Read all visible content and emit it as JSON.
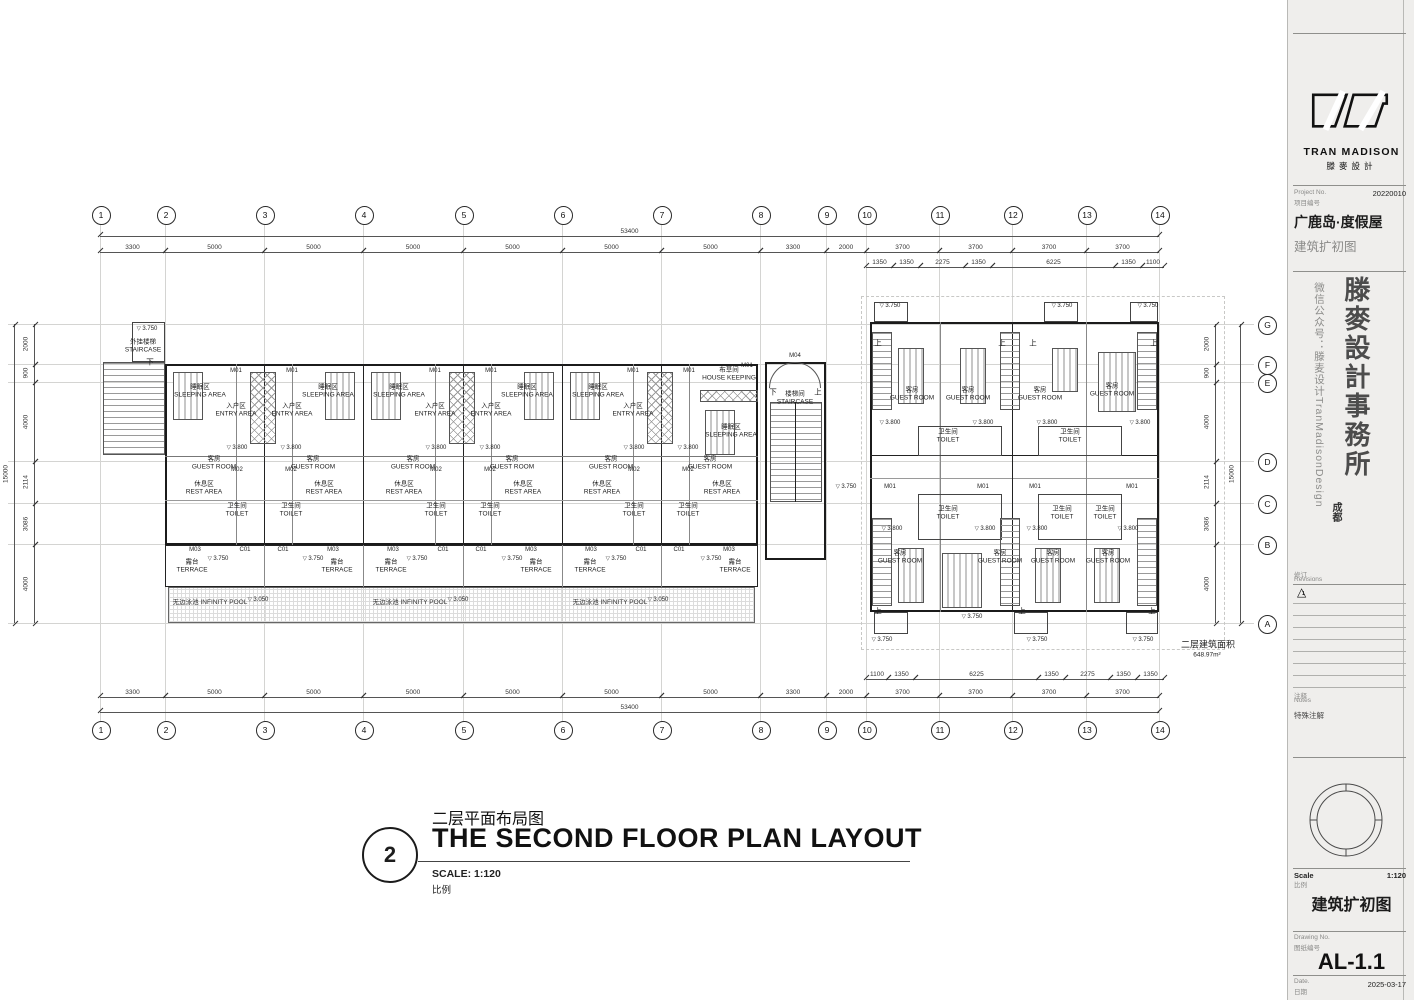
{
  "sheet": {
    "brand": "TRAN MADISON",
    "brand_zh": "滕麥設計",
    "project_no_label_en": "Project No.",
    "project_no_label_zh": "项目编号",
    "project_no": "20220010",
    "project_name_zh": "广鹿岛·度假屋",
    "project_stage_zh": "建筑扩初图",
    "wechat_vertical": "微信公众号：滕麦设计TranMadisonDesign",
    "office_vertical": "滕麥設計事務所",
    "office_city": "成都",
    "revisions_label_zh": "修订",
    "revisions_label_en": "Revisions",
    "revision_icon": "△",
    "revision_no": "1",
    "notes_label_zh": "注释",
    "notes_label_en": "Notes",
    "notes_special_zh": "特殊注解",
    "scale_label_en": "Scale",
    "scale_label_zh": "比例",
    "scale_value": "1:120",
    "stage_title_zh": "建筑扩初图",
    "drawing_no_label_en": "Drawing No.",
    "drawing_no_label_zh": "图纸编号",
    "drawing_no": "AL-1.1",
    "date_label_en": "Date.",
    "date_label_zh": "日期",
    "date_value": "2025-03-17"
  },
  "drawing_title": {
    "number": "2",
    "title_zh": "二层平面布局图",
    "title_en": "THE SECOND FLOOR PLAN LAYOUT",
    "scale_text": "SCALE: 1:120",
    "scale_zh": "比例"
  },
  "grid": {
    "columns": [
      {
        "label": "1",
        "x": 100
      },
      {
        "label": "2",
        "x": 165
      },
      {
        "label": "3",
        "x": 264
      },
      {
        "label": "4",
        "x": 363
      },
      {
        "label": "5",
        "x": 463
      },
      {
        "label": "6",
        "x": 562
      },
      {
        "label": "7",
        "x": 661
      },
      {
        "label": "8",
        "x": 760
      },
      {
        "label": "9",
        "x": 826
      },
      {
        "label": "10",
        "x": 866
      },
      {
        "label": "11",
        "x": 939
      },
      {
        "label": "12",
        "x": 1012
      },
      {
        "label": "13",
        "x": 1086
      },
      {
        "label": "14",
        "x": 1159
      }
    ],
    "col_boundaries": [
      100,
      165,
      264,
      363,
      463,
      562,
      661,
      760,
      826,
      866,
      939,
      1012,
      1086,
      1159
    ],
    "col_dim_values": [
      "3300",
      "5000",
      "5000",
      "5000",
      "5000",
      "5000",
      "5000",
      "3300",
      "2000",
      "3700",
      "3700",
      "3700",
      "3700"
    ],
    "col_total": "53400",
    "sub_top": {
      "boundaries": [
        866,
        893,
        920,
        965,
        992,
        1115,
        1142,
        1164
      ],
      "values": [
        "1350",
        "1350",
        "2275",
        "1350",
        "6225",
        "1350",
        "1100"
      ]
    },
    "sub_bottom": {
      "boundaries": [
        866,
        888,
        915,
        1038,
        1065,
        1110,
        1137,
        1164
      ],
      "values": [
        "1100",
        "1350",
        "6225",
        "1350",
        "2275",
        "1350",
        "1350"
      ]
    },
    "rows": [
      {
        "label": "G",
        "y": 324
      },
      {
        "label": "F",
        "y": 364
      },
      {
        "label": "E",
        "y": 382
      },
      {
        "label": "D",
        "y": 461
      },
      {
        "label": "C",
        "y": 503
      },
      {
        "label": "B",
        "y": 544
      },
      {
        "label": "A",
        "y": 623
      }
    ],
    "row_boundaries": [
      324,
      364,
      382,
      461,
      503,
      544,
      623
    ],
    "row_dim_values": [
      "2000",
      "900",
      "4000",
      "2114",
      "3086",
      "4000"
    ],
    "row_total": "15000"
  },
  "plan_labels": [
    [
      147,
      329,
      "3.750",
      "level"
    ],
    [
      143,
      347,
      "外挂楼梯\nSTAIRCASE",
      "room"
    ],
    [
      150,
      362,
      "下",
      "dir"
    ],
    [
      236,
      371,
      "M01",
      "tag"
    ],
    [
      292,
      371,
      "M01",
      "tag"
    ],
    [
      435,
      371,
      "M01",
      "tag"
    ],
    [
      491,
      371,
      "M01",
      "tag"
    ],
    [
      633,
      371,
      "M01",
      "tag"
    ],
    [
      689,
      371,
      "M01",
      "tag"
    ],
    [
      747,
      366,
      "M01",
      "tag"
    ],
    [
      795,
      356,
      "M04",
      "tag"
    ],
    [
      236,
      411,
      "入户区\nENTRY AREA",
      "room"
    ],
    [
      292,
      411,
      "入户区\nENTRY AREA",
      "room"
    ],
    [
      435,
      411,
      "入户区\nENTRY AREA",
      "room"
    ],
    [
      491,
      411,
      "入户区\nENTRY AREA",
      "room"
    ],
    [
      633,
      411,
      "入户区\nENTRY AREA",
      "room"
    ],
    [
      200,
      392,
      "睡眠区\nSLEEPING AREA",
      "room"
    ],
    [
      328,
      392,
      "睡眠区\nSLEEPING AREA",
      "room"
    ],
    [
      399,
      392,
      "睡眠区\nSLEEPING AREA",
      "room"
    ],
    [
      527,
      392,
      "睡眠区\nSLEEPING AREA",
      "room"
    ],
    [
      598,
      392,
      "睡眠区\nSLEEPING AREA",
      "room"
    ],
    [
      731,
      432,
      "睡眠区\nSLEEPING AREA",
      "room"
    ],
    [
      237,
      448,
      "3.800",
      "level"
    ],
    [
      291,
      448,
      "3.800",
      "level"
    ],
    [
      436,
      448,
      "3.800",
      "level"
    ],
    [
      490,
      448,
      "3.800",
      "level"
    ],
    [
      634,
      448,
      "3.800",
      "level"
    ],
    [
      688,
      448,
      "3.800",
      "level"
    ],
    [
      214,
      464,
      "客房\nGUEST ROOM",
      "room"
    ],
    [
      313,
      464,
      "客房\nGUEST ROOM",
      "room"
    ],
    [
      413,
      464,
      "客房\nGUEST ROOM",
      "room"
    ],
    [
      512,
      464,
      "客房\nGUEST ROOM",
      "room"
    ],
    [
      611,
      464,
      "客房\nGUEST ROOM",
      "room"
    ],
    [
      710,
      464,
      "客房\nGUEST ROOM",
      "room"
    ],
    [
      237,
      470,
      "M02",
      "tag"
    ],
    [
      291,
      470,
      "M02",
      "tag"
    ],
    [
      436,
      470,
      "M02",
      "tag"
    ],
    [
      490,
      470,
      "M02",
      "tag"
    ],
    [
      634,
      470,
      "M02",
      "tag"
    ],
    [
      688,
      470,
      "M02",
      "tag"
    ],
    [
      204,
      489,
      "休息区\nREST AREA",
      "room"
    ],
    [
      324,
      489,
      "休息区\nREST AREA",
      "room"
    ],
    [
      404,
      489,
      "休息区\nREST AREA",
      "room"
    ],
    [
      523,
      489,
      "休息区\nREST AREA",
      "room"
    ],
    [
      602,
      489,
      "休息区\nREST AREA",
      "room"
    ],
    [
      722,
      489,
      "休息区\nREST AREA",
      "room"
    ],
    [
      237,
      511,
      "卫生间\nTOILET",
      "room"
    ],
    [
      291,
      511,
      "卫生间\nTOILET",
      "room"
    ],
    [
      436,
      511,
      "卫生间\nTOILET",
      "room"
    ],
    [
      490,
      511,
      "卫生间\nTOILET",
      "room"
    ],
    [
      634,
      511,
      "卫生间\nTOILET",
      "room"
    ],
    [
      688,
      511,
      "卫生间\nTOILET",
      "room"
    ],
    [
      195,
      550,
      "M03",
      "tag"
    ],
    [
      333,
      550,
      "M03",
      "tag"
    ],
    [
      393,
      550,
      "M03",
      "tag"
    ],
    [
      531,
      550,
      "M03",
      "tag"
    ],
    [
      591,
      550,
      "M03",
      "tag"
    ],
    [
      729,
      550,
      "M03",
      "tag"
    ],
    [
      245,
      550,
      "C01",
      "tag"
    ],
    [
      283,
      550,
      "C01",
      "tag"
    ],
    [
      443,
      550,
      "C01",
      "tag"
    ],
    [
      481,
      550,
      "C01",
      "tag"
    ],
    [
      641,
      550,
      "C01",
      "tag"
    ],
    [
      679,
      550,
      "C01",
      "tag"
    ],
    [
      192,
      567,
      "露台\nTERRACE",
      "room"
    ],
    [
      337,
      567,
      "露台\nTERRACE",
      "room"
    ],
    [
      391,
      567,
      "露台\nTERRACE",
      "room"
    ],
    [
      536,
      567,
      "露台\nTERRACE",
      "room"
    ],
    [
      590,
      567,
      "露台\nTERRACE",
      "room"
    ],
    [
      735,
      567,
      "露台\nTERRACE",
      "room"
    ],
    [
      218,
      559,
      "3.750",
      "level"
    ],
    [
      313,
      559,
      "3.750",
      "level"
    ],
    [
      417,
      559,
      "3.750",
      "level"
    ],
    [
      512,
      559,
      "3.750",
      "level"
    ],
    [
      616,
      559,
      "3.750",
      "level"
    ],
    [
      711,
      559,
      "3.750",
      "level"
    ],
    [
      210,
      601,
      "无边泳池 INFINITY POOL",
      "pool-l"
    ],
    [
      410,
      601,
      "无边泳池 INFINITY POOL",
      "pool-l"
    ],
    [
      610,
      601,
      "无边泳池 INFINITY POOL",
      "pool-l"
    ],
    [
      258,
      600,
      "3.050",
      "level"
    ],
    [
      458,
      600,
      "3.050",
      "level"
    ],
    [
      658,
      600,
      "3.050",
      "level"
    ],
    [
      795,
      399,
      "楼梯间\nSTAIRCASE",
      "room"
    ],
    [
      773,
      392,
      "下",
      "dir"
    ],
    [
      818,
      392,
      "上",
      "dir"
    ],
    [
      846,
      487,
      "3.750",
      "level"
    ],
    [
      729,
      375,
      "布草间\nHOUSE KEEPING",
      "room"
    ],
    [
      890,
      306,
      "3.750",
      "level"
    ],
    [
      1062,
      306,
      "3.750",
      "level"
    ],
    [
      1148,
      306,
      "3.750",
      "level"
    ],
    [
      878,
      343,
      "上",
      "dir"
    ],
    [
      1002,
      343,
      "上",
      "dir"
    ],
    [
      1033,
      343,
      "上",
      "dir"
    ],
    [
      1154,
      343,
      "上",
      "dir"
    ],
    [
      912,
      395,
      "客房\nGUEST ROOM",
      "room"
    ],
    [
      968,
      395,
      "客房\nGUEST ROOM",
      "room"
    ],
    [
      1040,
      395,
      "客房\nGUEST ROOM",
      "room"
    ],
    [
      1112,
      391,
      "客房\nGUEST ROOM",
      "room"
    ],
    [
      948,
      437,
      "卫生间\nTOILET",
      "room"
    ],
    [
      1070,
      437,
      "卫生间\nTOILET",
      "room"
    ],
    [
      890,
      423,
      "3.800",
      "level"
    ],
    [
      983,
      423,
      "3.800",
      "level"
    ],
    [
      1047,
      423,
      "3.800",
      "level"
    ],
    [
      1140,
      423,
      "3.800",
      "level"
    ],
    [
      890,
      487,
      "M01",
      "tag"
    ],
    [
      983,
      487,
      "M01",
      "tag"
    ],
    [
      1035,
      487,
      "M01",
      "tag"
    ],
    [
      1132,
      487,
      "M01",
      "tag"
    ],
    [
      948,
      514,
      "卫生间\nTOILET",
      "room"
    ],
    [
      1062,
      514,
      "卫生间\nTOILET",
      "room"
    ],
    [
      1105,
      514,
      "卫生间\nTOILET",
      "room"
    ],
    [
      892,
      529,
      "3.800",
      "level"
    ],
    [
      985,
      529,
      "3.800",
      "level"
    ],
    [
      1037,
      529,
      "3.800",
      "level"
    ],
    [
      1128,
      529,
      "3.800",
      "level"
    ],
    [
      900,
      558,
      "客房\nGUEST ROOM",
      "room"
    ],
    [
      1000,
      558,
      "客房\nGUEST ROOM",
      "room"
    ],
    [
      1053,
      558,
      "客房\nGUEST ROOM",
      "room"
    ],
    [
      1108,
      558,
      "客房\nGUEST ROOM",
      "room"
    ],
    [
      878,
      611,
      "上",
      "dir"
    ],
    [
      1022,
      611,
      "上",
      "dir"
    ],
    [
      1152,
      611,
      "上",
      "dir"
    ],
    [
      972,
      617,
      "3.750",
      "level"
    ],
    [
      882,
      640,
      "3.750",
      "level"
    ],
    [
      1037,
      640,
      "3.750",
      "level"
    ],
    [
      1143,
      640,
      "3.750",
      "level"
    ],
    [
      1208,
      644,
      "二层建筑面积",
      "note"
    ],
    [
      1207,
      655,
      "648.97m²",
      "notev"
    ]
  ]
}
